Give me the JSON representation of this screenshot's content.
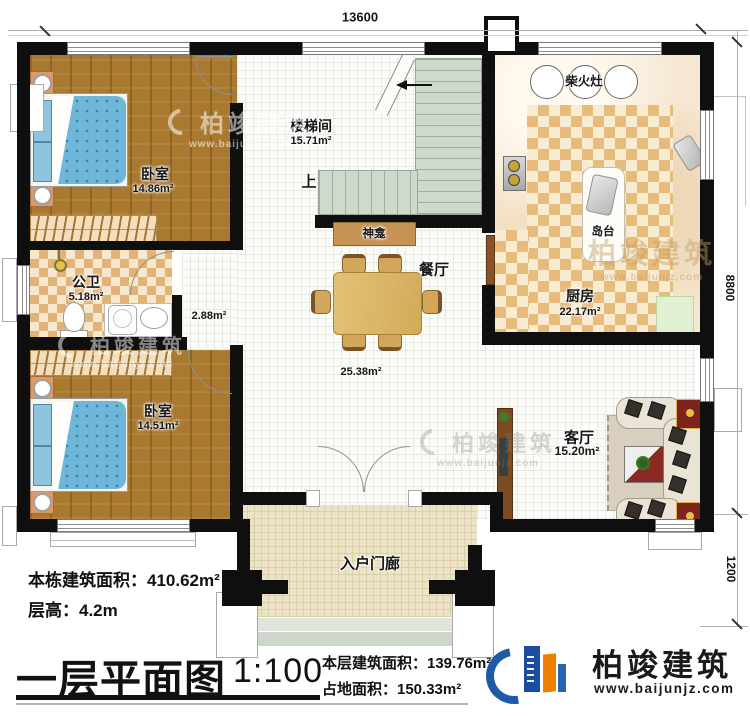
{
  "dimensions": {
    "width": "13600",
    "height_main": "8800",
    "height_porch": "1200"
  },
  "rooms": {
    "bedroom_top": {
      "name": "卧室",
      "area": "14.86m²"
    },
    "stairwell": {
      "name": "楼梯间",
      "area": "15.71m²",
      "up_label": "上"
    },
    "kitchen": {
      "name": "厨房",
      "area": "22.17m²",
      "stove_label": "柴火灶",
      "island_label": "岛台"
    },
    "bathroom": {
      "name": "公卫",
      "area": "5.18m²"
    },
    "corridor": {
      "area": "2.88m²"
    },
    "bedroom_bottom": {
      "name": "卧室",
      "area": "14.51m²"
    },
    "dining": {
      "name": "餐厅",
      "area": "25.38m²",
      "shrine_label": "神龛"
    },
    "living": {
      "name": "客厅",
      "area": "15.20m²"
    },
    "porch": {
      "name": "入户门廊"
    }
  },
  "notes": {
    "building_total": "本栋建筑面积：410.62m²",
    "floor_height": "层高：4.2m"
  },
  "title_block": {
    "title": "一层平面图",
    "scale": "1:100",
    "floor_area": "本层建筑面积：139.76m²",
    "footprint": "占地面积：150.33m²"
  },
  "brand": {
    "name": "柏竣建筑",
    "url": "www.baijunjz.com"
  },
  "watermark": {
    "name": "柏竣建筑",
    "url": "www.baijunjz.com"
  },
  "colors": {
    "wall": "#0f0f0f",
    "wood": "#a9792f",
    "checker": "#e7bb79",
    "stair": "#cfdacd",
    "brand_blue": "#1e5aa8",
    "brand_orange": "#f07f00",
    "accent_red": "#7c231b"
  }
}
